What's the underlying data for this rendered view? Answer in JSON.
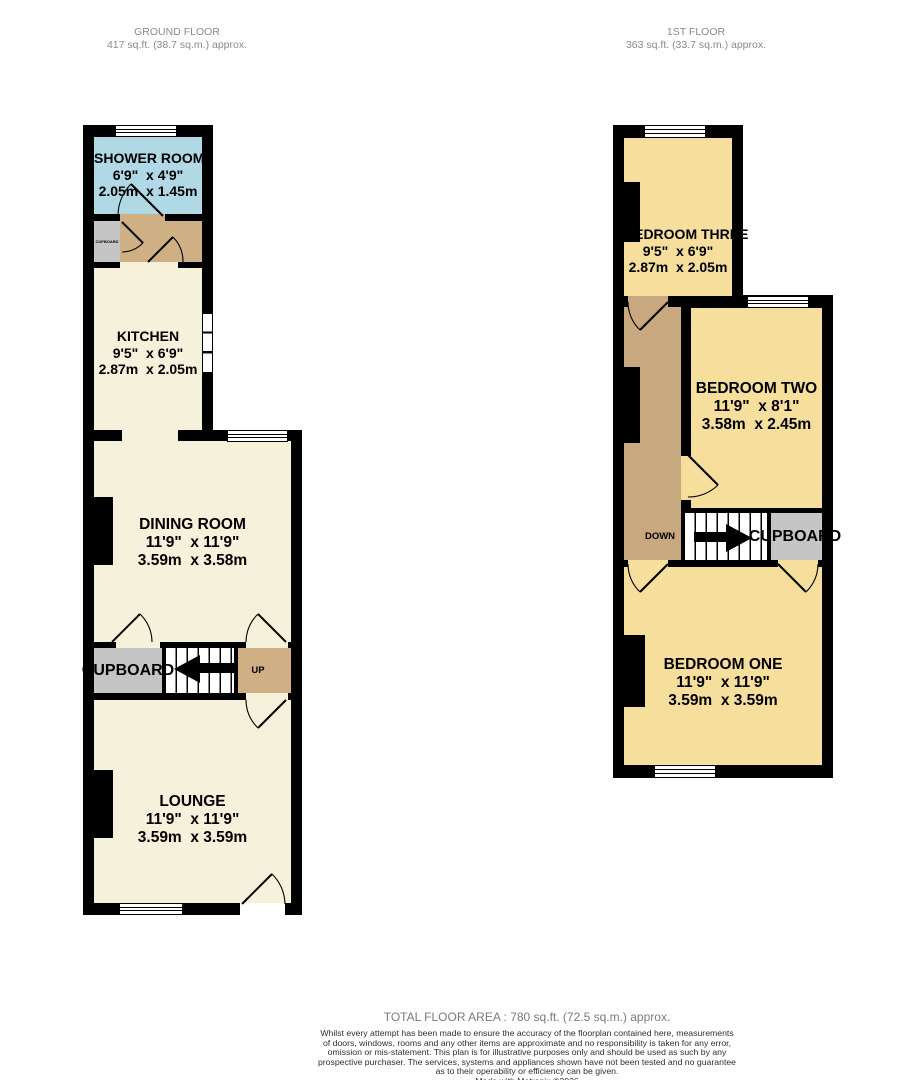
{
  "colors": {
    "wall": "#000000",
    "cream": "#f6f1da",
    "blue": "#b0d8e5",
    "yellow": "#f6de9d",
    "tan": "#cfb085",
    "tan2": "#c8a87e",
    "gray": "#c5c5c5",
    "header": "#8a8a8a"
  },
  "ground_floor": {
    "title": "GROUND FLOOR",
    "area": "417 sq.ft. (38.7 sq.m.) approx.",
    "rooms": {
      "shower_room": {
        "name": "SHOWER ROOM",
        "imperial": "6'9\"  x 4'9\"",
        "metric": "2.05m  x 1.45m"
      },
      "kitchen": {
        "name": "KITCHEN",
        "imperial": "9'5\"  x 6'9\"",
        "metric": "2.87m  x 2.05m"
      },
      "dining_room": {
        "name": "DINING ROOM",
        "imperial": "11'9\"  x 11'9\"",
        "metric": "3.59m  x 3.58m"
      },
      "lounge": {
        "name": "LOUNGE",
        "imperial": "11'9\"  x 11'9\"",
        "metric": "3.59m  x 3.59m"
      }
    },
    "labels": {
      "cupboard_small": "CUPBOARD",
      "cupboard": "CUPBOARD",
      "up": "UP"
    }
  },
  "first_floor": {
    "title": "1ST FLOOR",
    "area": "363 sq.ft. (33.7 sq.m.) approx.",
    "rooms": {
      "bedroom_three": {
        "name": "BEDROOM THREE",
        "imperial": "9'5\"  x 6'9\"",
        "metric": "2.87m  x 2.05m"
      },
      "bedroom_two": {
        "name": "BEDROOM TWO",
        "imperial": "11'9\"  x 8'1\"",
        "metric": "3.58m  x 2.45m"
      },
      "bedroom_one": {
        "name": "BEDROOM ONE",
        "imperial": "11'9\"  x 11'9\"",
        "metric": "3.59m  x 3.59m"
      }
    },
    "labels": {
      "down": "DOWN",
      "cupboard": "CUPBOARD"
    }
  },
  "footer": {
    "total": "TOTAL FLOOR AREA : 780 sq.ft. (72.5 sq.m.) approx.",
    "disclaimer": "Whilst every attempt has been made to ensure the accuracy of the floorplan contained here, measurements\nof doors, windows, rooms and any other items are approximate and no responsibility is taken for any error,\nomission or mis-statement. This plan is for illustrative purposes only and should be used as such by any\nprospective purchaser. The services, systems and appliances shown have not been tested and no guarantee\nas to their operability or efficiency can be given.",
    "credit": "Made with Metropix ©2026"
  }
}
